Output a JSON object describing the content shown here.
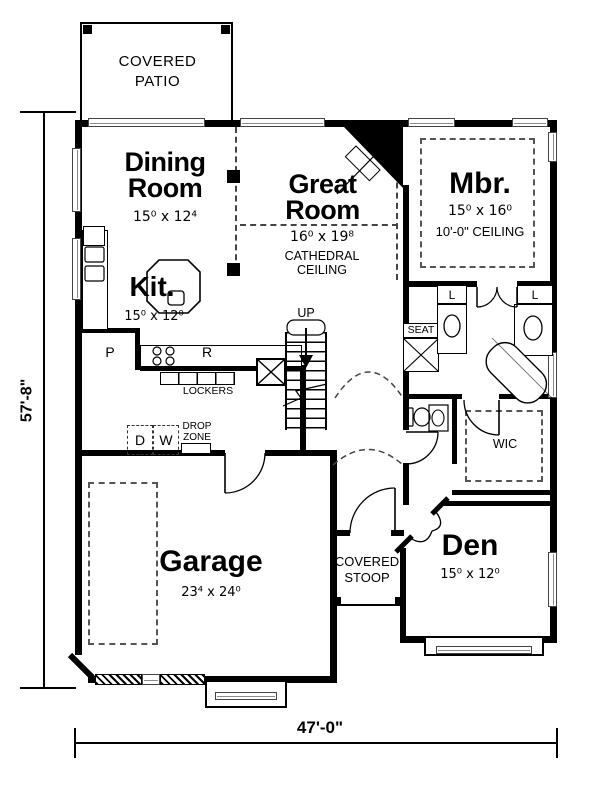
{
  "rooms": {
    "dining": {
      "name": "Dining Room",
      "dims": "15⁰ x 12⁴"
    },
    "great": {
      "name": "Great Room",
      "dims": "16⁰ x 19⁸",
      "note": "CATHEDRAL CEILING"
    },
    "master": {
      "name": "Mbr.",
      "dims": "15⁰ x 16⁰",
      "note": "10'-0\" CEILING"
    },
    "kitchen": {
      "name": "Kit.",
      "dims": "15⁰ x 12⁰"
    },
    "garage": {
      "name": "Garage",
      "dims": "23⁴ x 24⁰"
    },
    "den": {
      "name": "Den",
      "dims": "15⁰ x 12⁰"
    },
    "wic": {
      "name": "WIC"
    }
  },
  "areas": {
    "covered_patio": "COVERED PATIO",
    "covered_stoop": "COVERED STOOP",
    "lockers": "LOCKERS",
    "drop_zone": "DROP ZONE",
    "seat": "SEAT",
    "stairs": "UP"
  },
  "fixtures": {
    "pantry": "P",
    "refrigerator": "R",
    "dryer": "D",
    "washer": "W",
    "linen1": "L",
    "linen2": "L"
  },
  "dimensions": {
    "depth": "57'-8\"",
    "width": "47'-0\""
  },
  "colors": {
    "wall": "#000000",
    "background": "#ffffff",
    "window_line": "#888888",
    "dashed_line": "#555555"
  }
}
